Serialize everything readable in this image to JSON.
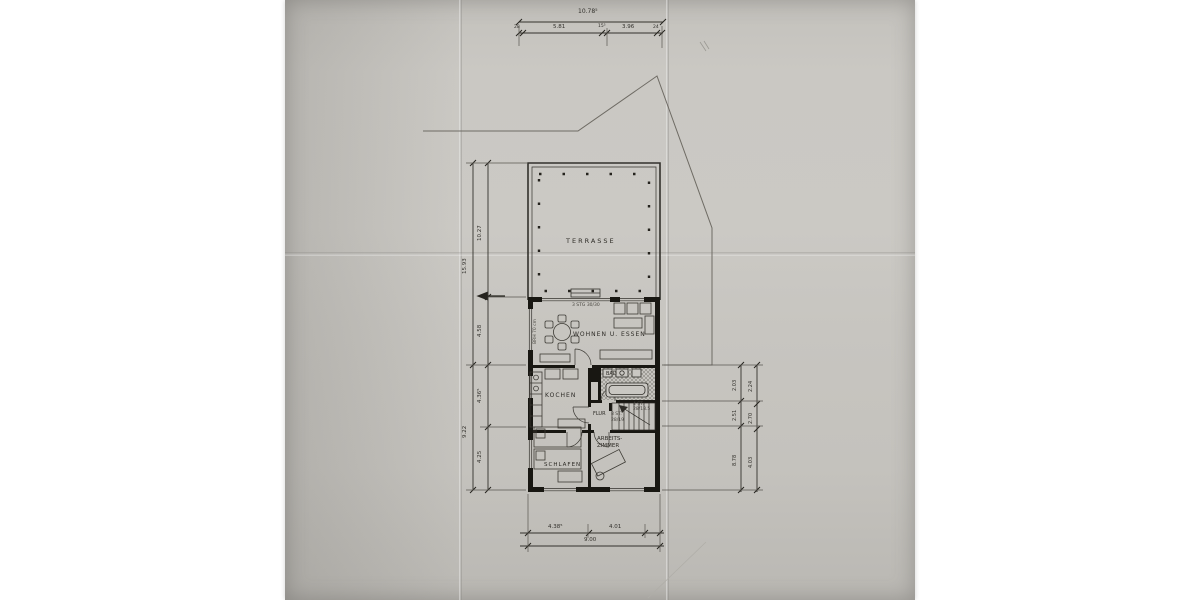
{
  "document": {
    "kind": "scanned architectural floor plan",
    "paper_color": "#c9c7c2",
    "ink_color": "#26241f",
    "wall_color": "#181712"
  },
  "rooms": {
    "terrasse": "TERRASSE",
    "wohnen": "WOHNEN U. ESSEN",
    "kueche": "KOCHEN",
    "bad": "BAD",
    "flur": "FLUR",
    "schlafen": "SCHLAFEN",
    "arbeits_line1": "ARBEITS-",
    "arbeits_line2": "ZIMMER"
  },
  "notes": {
    "step": "3 STG 30/30",
    "parapet": "BRH 70 cm",
    "stair_a1": "4 ST.",
    "stair_a2": "28/18.5",
    "stair_b1": "8 ST.",
    "stair_b2": "28/19"
  },
  "dims": {
    "top": {
      "total": "10.78⁵",
      "wall_l": "28",
      "seg1": "5.81",
      "mid": "15⁵",
      "seg2": "3.96",
      "wall_r": "24"
    },
    "left_outer": {
      "upper": "15.93",
      "lower": "9.22"
    },
    "left_inner": {
      "s1": "10.27",
      "s2": "4.58",
      "s3": "4.36⁵",
      "s4": "4.25"
    },
    "right_inner": {
      "s1": "2.03",
      "s2": "2.51",
      "s3": "8.78"
    },
    "right_outer": {
      "s1": "2.24",
      "s2": "2.70",
      "s3": "4.03"
    },
    "bottom": {
      "seg1": "4.38⁵",
      "seg2": "4.01",
      "total": "9.00"
    }
  }
}
